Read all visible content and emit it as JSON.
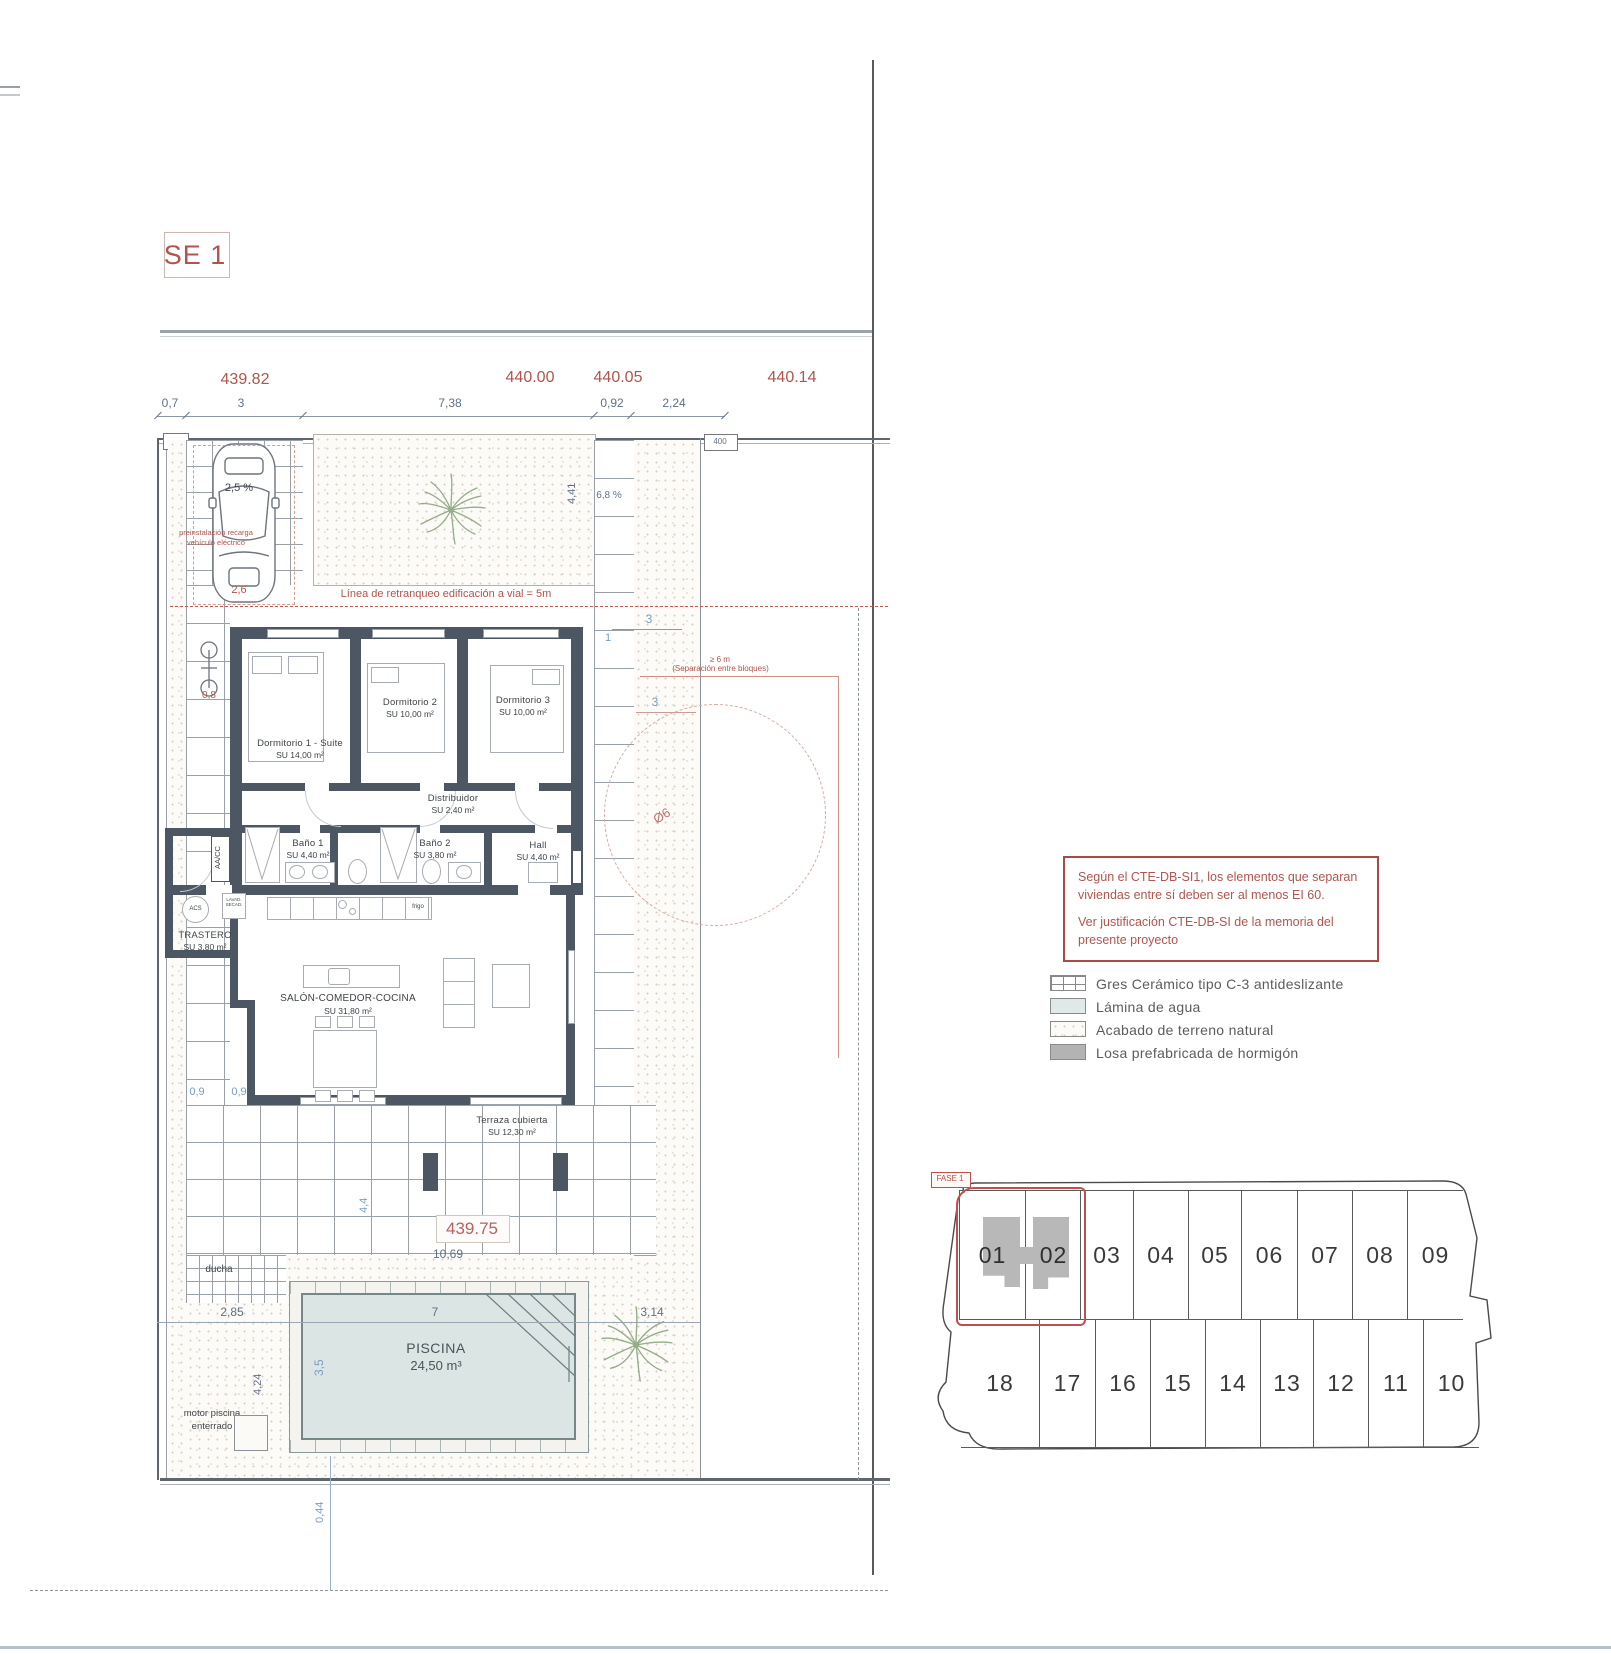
{
  "title": {
    "label": "SE 1"
  },
  "top_dims": {
    "elevations": [
      "439.82",
      "440.00",
      "440.05",
      "440.14"
    ],
    "segments": [
      "0,7",
      "3",
      "7,38",
      "0,92",
      "2,24"
    ]
  },
  "elev_terrace": "439.75",
  "site_labels": {
    "retranqueo": "Línea de retranqueo edificación a vial = 5m",
    "recarga": "preinstalación recarga vehículo eléctrico",
    "separacion_line1": "≥ 6 m",
    "separacion_line2": "(Separación entre bloques)",
    "diameter": "Ø6",
    "slope_garage": "2,5 %",
    "slope_side": "6,8 %",
    "ducha": "ducha",
    "motor": "motor piscina enterrado",
    "aacc": "AA/CC",
    "acs": "ACS",
    "lavad": "LAVAD. SECAD.",
    "frigo": "frigo",
    "box_400": "400"
  },
  "dims": {
    "d_26": "2,6",
    "d_08": "0,8",
    "d_441": "4,41",
    "d_1": "1",
    "d_3a": "3",
    "d_3b": "3",
    "d_09a": "0,9",
    "d_09b": "0,9",
    "d_44": "4,4",
    "d_1069": "10,69",
    "d_285": "2,85",
    "d_7": "7",
    "d_314": "3,14",
    "d_35": "3,5",
    "d_424": "4,24",
    "d_044": "0,44"
  },
  "rooms": [
    {
      "name": "Dormitorio 1 - Suite",
      "area": "SU 14,00 m²"
    },
    {
      "name": "Dormitorio 2",
      "area": "SU 10,00 m²"
    },
    {
      "name": "Dormitorio 3",
      "area": "SU 10,00 m²"
    },
    {
      "name": "Distribuidor",
      "area": "SU 2,40 m²"
    },
    {
      "name": "Baño 1",
      "area": "SU 4,40 m²"
    },
    {
      "name": "Baño 2",
      "area": "SU 3,80 m²"
    },
    {
      "name": "Hall",
      "area": "SU 4,40 m²"
    },
    {
      "name": "TRASTERO",
      "area": "SU 3,80 m²"
    },
    {
      "name": "SALÓN-COMEDOR-COCINA",
      "area": "SU 31,80 m²"
    },
    {
      "name": "Terraza cubierta",
      "area": "SU 12,30 m²"
    },
    {
      "name": "PISCINA",
      "area": "24,50 m³"
    }
  ],
  "note_box": {
    "line1": "Según el CTE-DB-SI1, los elementos que separan viviendas entre sí deben ser al menos EI 60.",
    "line2": "Ver justificación CTE-DB-SI de la memoria del presente proyecto"
  },
  "legend": {
    "items": [
      {
        "label": "Gres Cerámico tipo C-3 antideslizante"
      },
      {
        "label": "Lámina de agua"
      },
      {
        "label": "Acabado de terreno natural"
      },
      {
        "label": "Losa prefabricada de hormigón"
      }
    ]
  },
  "site_key": {
    "fase": "FASE 1",
    "top_row": [
      "01",
      "02",
      "03",
      "04",
      "05",
      "06",
      "07",
      "08",
      "09"
    ],
    "bottom_row": [
      "18",
      "17",
      "16",
      "15",
      "14",
      "13",
      "12",
      "11",
      "10"
    ]
  },
  "colors": {
    "wall": "#4d5663",
    "accent_red": "#b0544c",
    "water": "#dbe5e4",
    "concrete": "#b3b3b3"
  }
}
